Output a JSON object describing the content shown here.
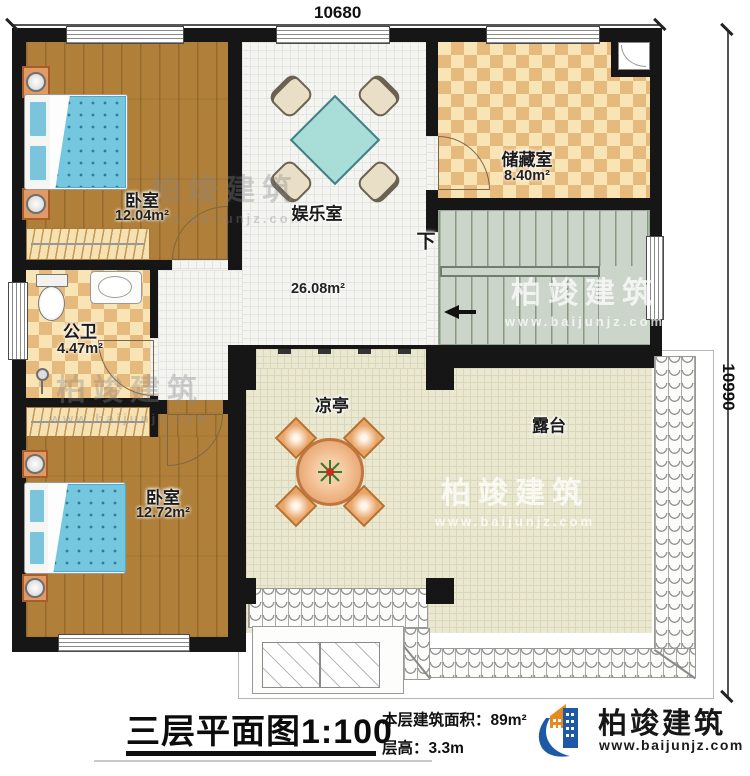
{
  "dimensions": {
    "top": "10680",
    "right": "10990"
  },
  "rooms": {
    "bedroom_top": {
      "name": "卧室",
      "area": "12.04m²"
    },
    "entertainment": {
      "name": "娱乐室",
      "area": "26.08m²"
    },
    "storage": {
      "name": "储藏室",
      "area": "8.40m²"
    },
    "bathroom": {
      "name": "公卫",
      "area": "4.47m²"
    },
    "bedroom_bottom": {
      "name": "卧室",
      "area": "12.72m²"
    },
    "pavilion": {
      "name": "凉亭"
    },
    "terrace": {
      "name": "露台"
    },
    "stair": {
      "down_label": "下"
    }
  },
  "footer": {
    "title": "三层平面图",
    "scale": "1:100",
    "area_label": "本层建筑面积：",
    "area_value": "89m²",
    "height_label": "层高：",
    "height_value": "3.3m"
  },
  "brand": {
    "name": "柏竣建筑",
    "website": "www.baijunjz.com"
  },
  "watermark": {
    "name": "柏竣建筑",
    "website": "www.baijunjz.com"
  },
  "colors": {
    "wall": "#161616",
    "accent_blue": "#1e59a6",
    "accent_orange": "#e8891d"
  }
}
